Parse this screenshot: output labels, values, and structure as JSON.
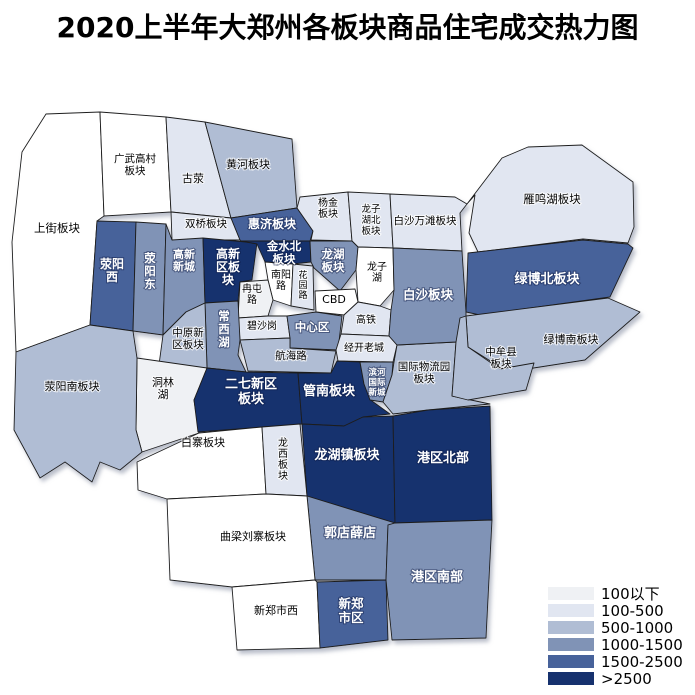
{
  "title": "2020上半年大郑州各板块商品住宅成交热力图",
  "legend": {
    "items": [
      {
        "label": "100以下",
        "color": "#eff1f4"
      },
      {
        "label": "100-500",
        "color": "#e1e6f1"
      },
      {
        "label": "500-1000",
        "color": "#b0bdd4"
      },
      {
        "label": "1000-1500",
        "color": "#8093b6"
      },
      {
        "label": "1500-2500",
        "color": "#47629a"
      },
      {
        "label": ">2500",
        "color": "#16316e"
      }
    ],
    "no_data_color": "#ffffff"
  },
  "chart_data": {
    "type": "heatmap",
    "subtype": "choropleth-district-map",
    "title": "2020上半年大郑州各板块商品住宅成交热力图",
    "legend_position": "bottom-right",
    "bins": [
      "100以下",
      "100-500",
      "500-1000",
      "1000-1500",
      "1500-2500",
      ">2500"
    ],
    "regions": [
      {
        "name": "上街板块",
        "range": "",
        "label": {
          "x": 57,
          "y": 232,
          "size": 11.5,
          "lines": [
            "上街板块"
          ]
        },
        "points": "22,152 46,114 100,112 104,216 97,221 90,325 16,352 12,242"
      },
      {
        "name": "广武高村板块",
        "range": "",
        "label": {
          "x": 135,
          "y": 162,
          "size": 10.5,
          "lines": [
            "广武高村",
            "板块"
          ]
        },
        "points": "100,112 166,117 171,212 104,216"
      },
      {
        "name": "古荥",
        "range": "100-500",
        "label": {
          "x": 193,
          "y": 182,
          "size": 11,
          "lines": [
            "古荥"
          ]
        },
        "points": "166,117 205,122 231,218 171,212"
      },
      {
        "name": "黄河板块",
        "range": "500-1000",
        "label": {
          "x": 248,
          "y": 168,
          "size": 11,
          "lines": [
            "黄河板块"
          ]
        },
        "points": "205,122 292,139 297,208 231,218"
      },
      {
        "name": "双桥板块",
        "range": "100-500",
        "label": {
          "x": 206,
          "y": 227,
          "size": 10.5,
          "lines": [
            "双桥板块"
          ]
        },
        "points": "171,212 231,218 240,240 172,240"
      },
      {
        "name": "荥阳西",
        "range": "1500-2500",
        "label": {
          "x": 112,
          "y": 268,
          "size": 12,
          "lines": [
            "荥阳",
            "西"
          ]
        },
        "points": "97,221 136,222 133,331 90,325"
      },
      {
        "name": "荥阳东",
        "range": "1000-1500",
        "label": {
          "x": 150,
          "y": 262,
          "size": 11.5,
          "lines": [
            "荥",
            "阳",
            "东"
          ]
        },
        "points": "136,222 166,224 163,335 133,331"
      },
      {
        "name": "高新新城",
        "range": "1000-1500",
        "label": {
          "x": 184,
          "y": 258,
          "size": 11,
          "lines": [
            "高新",
            "新城"
          ]
        },
        "points": "166,224 172,240 203,238 205,303 186,312 163,335"
      },
      {
        "name": "高新区板块",
        "range": ">2500",
        "label": {
          "x": 228,
          "y": 258,
          "size": 12,
          "lines": [
            "高新",
            "区板",
            "块"
          ]
        },
        "points": "203,238 257,243 252,280 240,282 238,301 205,303"
      },
      {
        "name": "惠济板块",
        "range": "1500-2500",
        "label": {
          "x": 272,
          "y": 228,
          "size": 12,
          "lines": [
            "惠济板块"
          ]
        },
        "points": "231,218 297,208 313,231 310,241 241,241 240,240"
      },
      {
        "name": "金水北板块",
        "range": ">2500",
        "label": {
          "x": 284,
          "y": 250,
          "size": 11.5,
          "lines": [
            "金水北",
            "板块"
          ]
        },
        "points": "241,241 310,241 311,262 293,264 265,262 257,244"
      },
      {
        "name": "杨金板块",
        "range": "100-500",
        "label": {
          "x": 328,
          "y": 206,
          "size": 10,
          "lines": [
            "杨金",
            "板块"
          ]
        },
        "points": "300,197 348,192 352,241 311,240 313,231 297,208"
      },
      {
        "name": "龙子湖北板块",
        "range": "100-500",
        "label": {
          "x": 371,
          "y": 212,
          "size": 9.5,
          "lines": [
            "龙子",
            "湖北",
            "板块"
          ]
        },
        "points": "348,192 390,194 393,248 358,247 352,241"
      },
      {
        "name": "白沙万滩板块",
        "range": "100-500",
        "label": {
          "x": 425,
          "y": 224,
          "size": 10.5,
          "lines": [
            "白沙万滩板块"
          ]
        },
        "points": "390,194 455,197 467,204 460,213 462,251 393,248"
      },
      {
        "name": "雁鸣湖板块",
        "range": "100-500",
        "label": {
          "x": 552,
          "y": 203,
          "size": 11.5,
          "lines": [
            "雁鸣湖板块"
          ]
        },
        "points": "467,204 502,158 528,147 582,145 633,182 634,227 628,243 583,239 478,252 469,233 475,195"
      },
      {
        "name": "龙湖板块",
        "range": "1000-1500",
        "label": {
          "x": 333,
          "y": 258,
          "size": 11.5,
          "lines": [
            "龙湖",
            "板块"
          ]
        },
        "points": "310,241 352,241 358,247 356,270 340,291 314,268 311,262"
      },
      {
        "name": "龙子湖",
        "range": "",
        "label": {
          "x": 377,
          "y": 270,
          "size": 10,
          "lines": [
            "龙子",
            "湖"
          ]
        },
        "points": "358,247 393,248 394,290 380,306 358,302 356,270"
      },
      {
        "name": "南阳路",
        "range": "",
        "label": {
          "x": 281,
          "y": 278,
          "size": 10,
          "lines": [
            "南阳",
            "路"
          ]
        },
        "points": "265,262 293,264 291,306 273,300 268,280"
      },
      {
        "name": "花园路",
        "range": "100-500",
        "label": {
          "x": 303,
          "y": 278,
          "size": 9,
          "lines": [
            "花",
            "园",
            "路"
          ]
        },
        "points": "293,264 313,266 314,310 291,306"
      },
      {
        "name": "CBD",
        "range": "",
        "label": {
          "x": 334,
          "y": 303,
          "size": 11,
          "lines": [
            "CBD"
          ]
        },
        "points": "315,291 355,289 358,302 344,315 316,312"
      },
      {
        "name": "冉屯路",
        "range": "100以下",
        "label": {
          "x": 252,
          "y": 292,
          "size": 10,
          "lines": [
            "冉屯",
            "路"
          ]
        },
        "points": "240,282 268,280 273,300 268,316 238,318"
      },
      {
        "name": "碧沙岗",
        "range": "100-500",
        "label": {
          "x": 262,
          "y": 329,
          "size": 10,
          "lines": [
            "碧沙岗"
          ]
        },
        "points": "238,318 268,316 287,316 290,338 240,340"
      },
      {
        "name": "中心区",
        "range": "1000-1500",
        "label": {
          "x": 312,
          "y": 331,
          "size": 11.5,
          "lines": [
            "中心区"
          ]
        },
        "points": "287,316 316,312 342,316 338,350 290,348 290,338"
      },
      {
        "name": "航海路",
        "range": "500-1000",
        "label": {
          "x": 291,
          "y": 359,
          "size": 10.5,
          "lines": [
            "航海路"
          ]
        },
        "points": "240,340 290,338 290,348 336,351 331,373 248,371"
      },
      {
        "name": "高铁",
        "range": "100-500",
        "label": {
          "x": 366,
          "y": 323,
          "size": 10,
          "lines": [
            "高铁"
          ]
        },
        "points": "344,315 358,302 380,306 391,310 389,336 341,334"
      },
      {
        "name": "经开老城",
        "range": "100-500",
        "label": {
          "x": 364,
          "y": 351,
          "size": 10,
          "lines": [
            "经开老城"
          ]
        },
        "points": "341,334 389,336 397,345 393,362 338,361 336,350"
      },
      {
        "name": "常西湖",
        "range": "1000-1500",
        "label": {
          "x": 224,
          "y": 320,
          "size": 11.5,
          "lines": [
            "常",
            "西",
            "湖"
          ]
        },
        "points": "205,303 238,301 240,340 238,355 246,372 207,368"
      },
      {
        "name": "中原新区板块",
        "range": "500-1000",
        "label": {
          "x": 188,
          "y": 336,
          "size": 10.5,
          "lines": [
            "中原新",
            "区板块"
          ]
        },
        "points": "163,335 186,312 205,303 207,368 185,380 158,372"
      },
      {
        "name": "洞林湖",
        "range": "100以下",
        "label": {
          "x": 163,
          "y": 386,
          "size": 11,
          "lines": [
            "洞林",
            "湖"
          ]
        },
        "points": "137,358 207,368 194,400 199,433 142,452 136,430"
      },
      {
        "name": "荥阳南板块",
        "range": "500-1000",
        "label": {
          "x": 72,
          "y": 390,
          "size": 11,
          "lines": [
            "荥阳南板块"
          ]
        },
        "points": "16,352 90,325 133,331 137,358 136,430 142,452 120,470 100,462 92,482 65,462 40,478 14,430"
      },
      {
        "name": "二七新区板块",
        "range": ">2500",
        "label": {
          "x": 251,
          "y": 388,
          "size": 13,
          "lines": [
            "二七新区",
            "板块"
          ]
        },
        "points": "207,368 246,372 298,373 302,424 262,427 198,432 194,400"
      },
      {
        "name": "管南板块",
        "range": ">2500",
        "label": {
          "x": 329,
          "y": 395,
          "size": 13,
          "lines": [
            "管南板块"
          ]
        },
        "points": "298,373 331,373 337,361 360,362 364,384 372,401 390,414 363,417 344,426 302,424"
      },
      {
        "name": "滨河国际新城",
        "range": "1000-1500",
        "label": {
          "x": 377,
          "y": 375,
          "size": 8.5,
          "lines": [
            "滨河",
            "国际",
            "新城"
          ]
        },
        "points": "360,362 393,362 392,375 383,402 370,400 364,384"
      },
      {
        "name": "国际物流园板块",
        "range": "500-1000",
        "label": {
          "x": 424,
          "y": 370,
          "size": 10.5,
          "lines": [
            "国际物流园",
            "板块"
          ]
        },
        "points": "397,345 456,342 452,396 490,404 428,410 393,414 383,402 392,375 394,362"
      },
      {
        "name": "白沙板块",
        "range": "1000-1500",
        "label": {
          "x": 428,
          "y": 299,
          "size": 12.5,
          "lines": [
            "白沙板块"
          ]
        },
        "points": "393,248 462,251 466,312 466,316 456,342 397,345 389,336 391,310 394,290"
      },
      {
        "name": "绿博北板块",
        "range": "1500-2500",
        "label": {
          "x": 547,
          "y": 283,
          "size": 13,
          "lines": [
            "绿博北板块"
          ]
        },
        "points": "468,253 583,240 628,244 633,248 610,297 480,315 466,312"
      },
      {
        "name": "绿博南板块",
        "range": "500-1000",
        "label": {
          "x": 571,
          "y": 343,
          "size": 11,
          "lines": [
            "绿博南板块"
          ]
        },
        "points": "466,316 608,298 640,312 585,360 508,372 468,347"
      },
      {
        "name": "中牟县板块",
        "range": "500-1000",
        "label": {
          "x": 501,
          "y": 355,
          "size": 10.5,
          "lines": [
            "中牟县",
            "板块"
          ]
        },
        "points": "460,318 466,316 468,347 500,369 534,363 526,390 468,400 452,396 456,342"
      },
      {
        "name": "白寨板块",
        "range": "",
        "label": {
          "x": 203,
          "y": 446,
          "size": 11,
          "lines": [
            "白寨板块"
          ]
        },
        "points": "137,462 199,433 262,427 266,494 167,499 138,490"
      },
      {
        "name": "龙西板块",
        "range": "100-500",
        "label": {
          "x": 283,
          "y": 446,
          "size": 10,
          "lines": [
            "龙",
            "西",
            "板",
            "块"
          ]
        },
        "points": "262,427 300,424 307,496 266,494"
      },
      {
        "name": "龙湖镇板块",
        "range": ">2500",
        "label": {
          "x": 347,
          "y": 459,
          "size": 13,
          "lines": [
            "龙湖镇板块"
          ]
        },
        "points": "302,424 344,426 363,417 393,416 395,523 307,496"
      },
      {
        "name": "港区北部",
        "range": ">2500",
        "label": {
          "x": 443,
          "y": 462,
          "size": 13,
          "lines": [
            "港区北部"
          ]
        },
        "points": "393,416 428,410 490,406 492,520 395,523"
      },
      {
        "name": "郭店薛店",
        "range": "1000-1500",
        "label": {
          "x": 350,
          "y": 537,
          "size": 13,
          "lines": [
            "郭店薛店"
          ]
        },
        "points": "307,496 395,523 388,525 386,580 315,580"
      },
      {
        "name": "曲梁刘寨板块",
        "range": "",
        "label": {
          "x": 253,
          "y": 540,
          "size": 11,
          "lines": [
            "曲梁刘寨板块"
          ]
        },
        "points": "167,499 266,494 307,496 315,580 232,587 170,580"
      },
      {
        "name": "港区南部",
        "range": "1000-1500",
        "label": {
          "x": 437,
          "y": 581,
          "size": 13,
          "lines": [
            "港区南部"
          ]
        },
        "points": "388,525 395,523 492,520 486,638 392,640 386,580"
      },
      {
        "name": "新郑市西",
        "range": "",
        "label": {
          "x": 276,
          "y": 614,
          "size": 11,
          "lines": [
            "新郑市西"
          ]
        },
        "points": "232,587 315,580 317,582 320,648 237,650"
      },
      {
        "name": "新郑市区",
        "range": "1500-2500",
        "label": {
          "x": 351,
          "y": 608,
          "size": 12.5,
          "lines": [
            "新郑",
            "市区"
          ]
        },
        "points": "317,582 386,580 388,640 320,648"
      }
    ]
  }
}
